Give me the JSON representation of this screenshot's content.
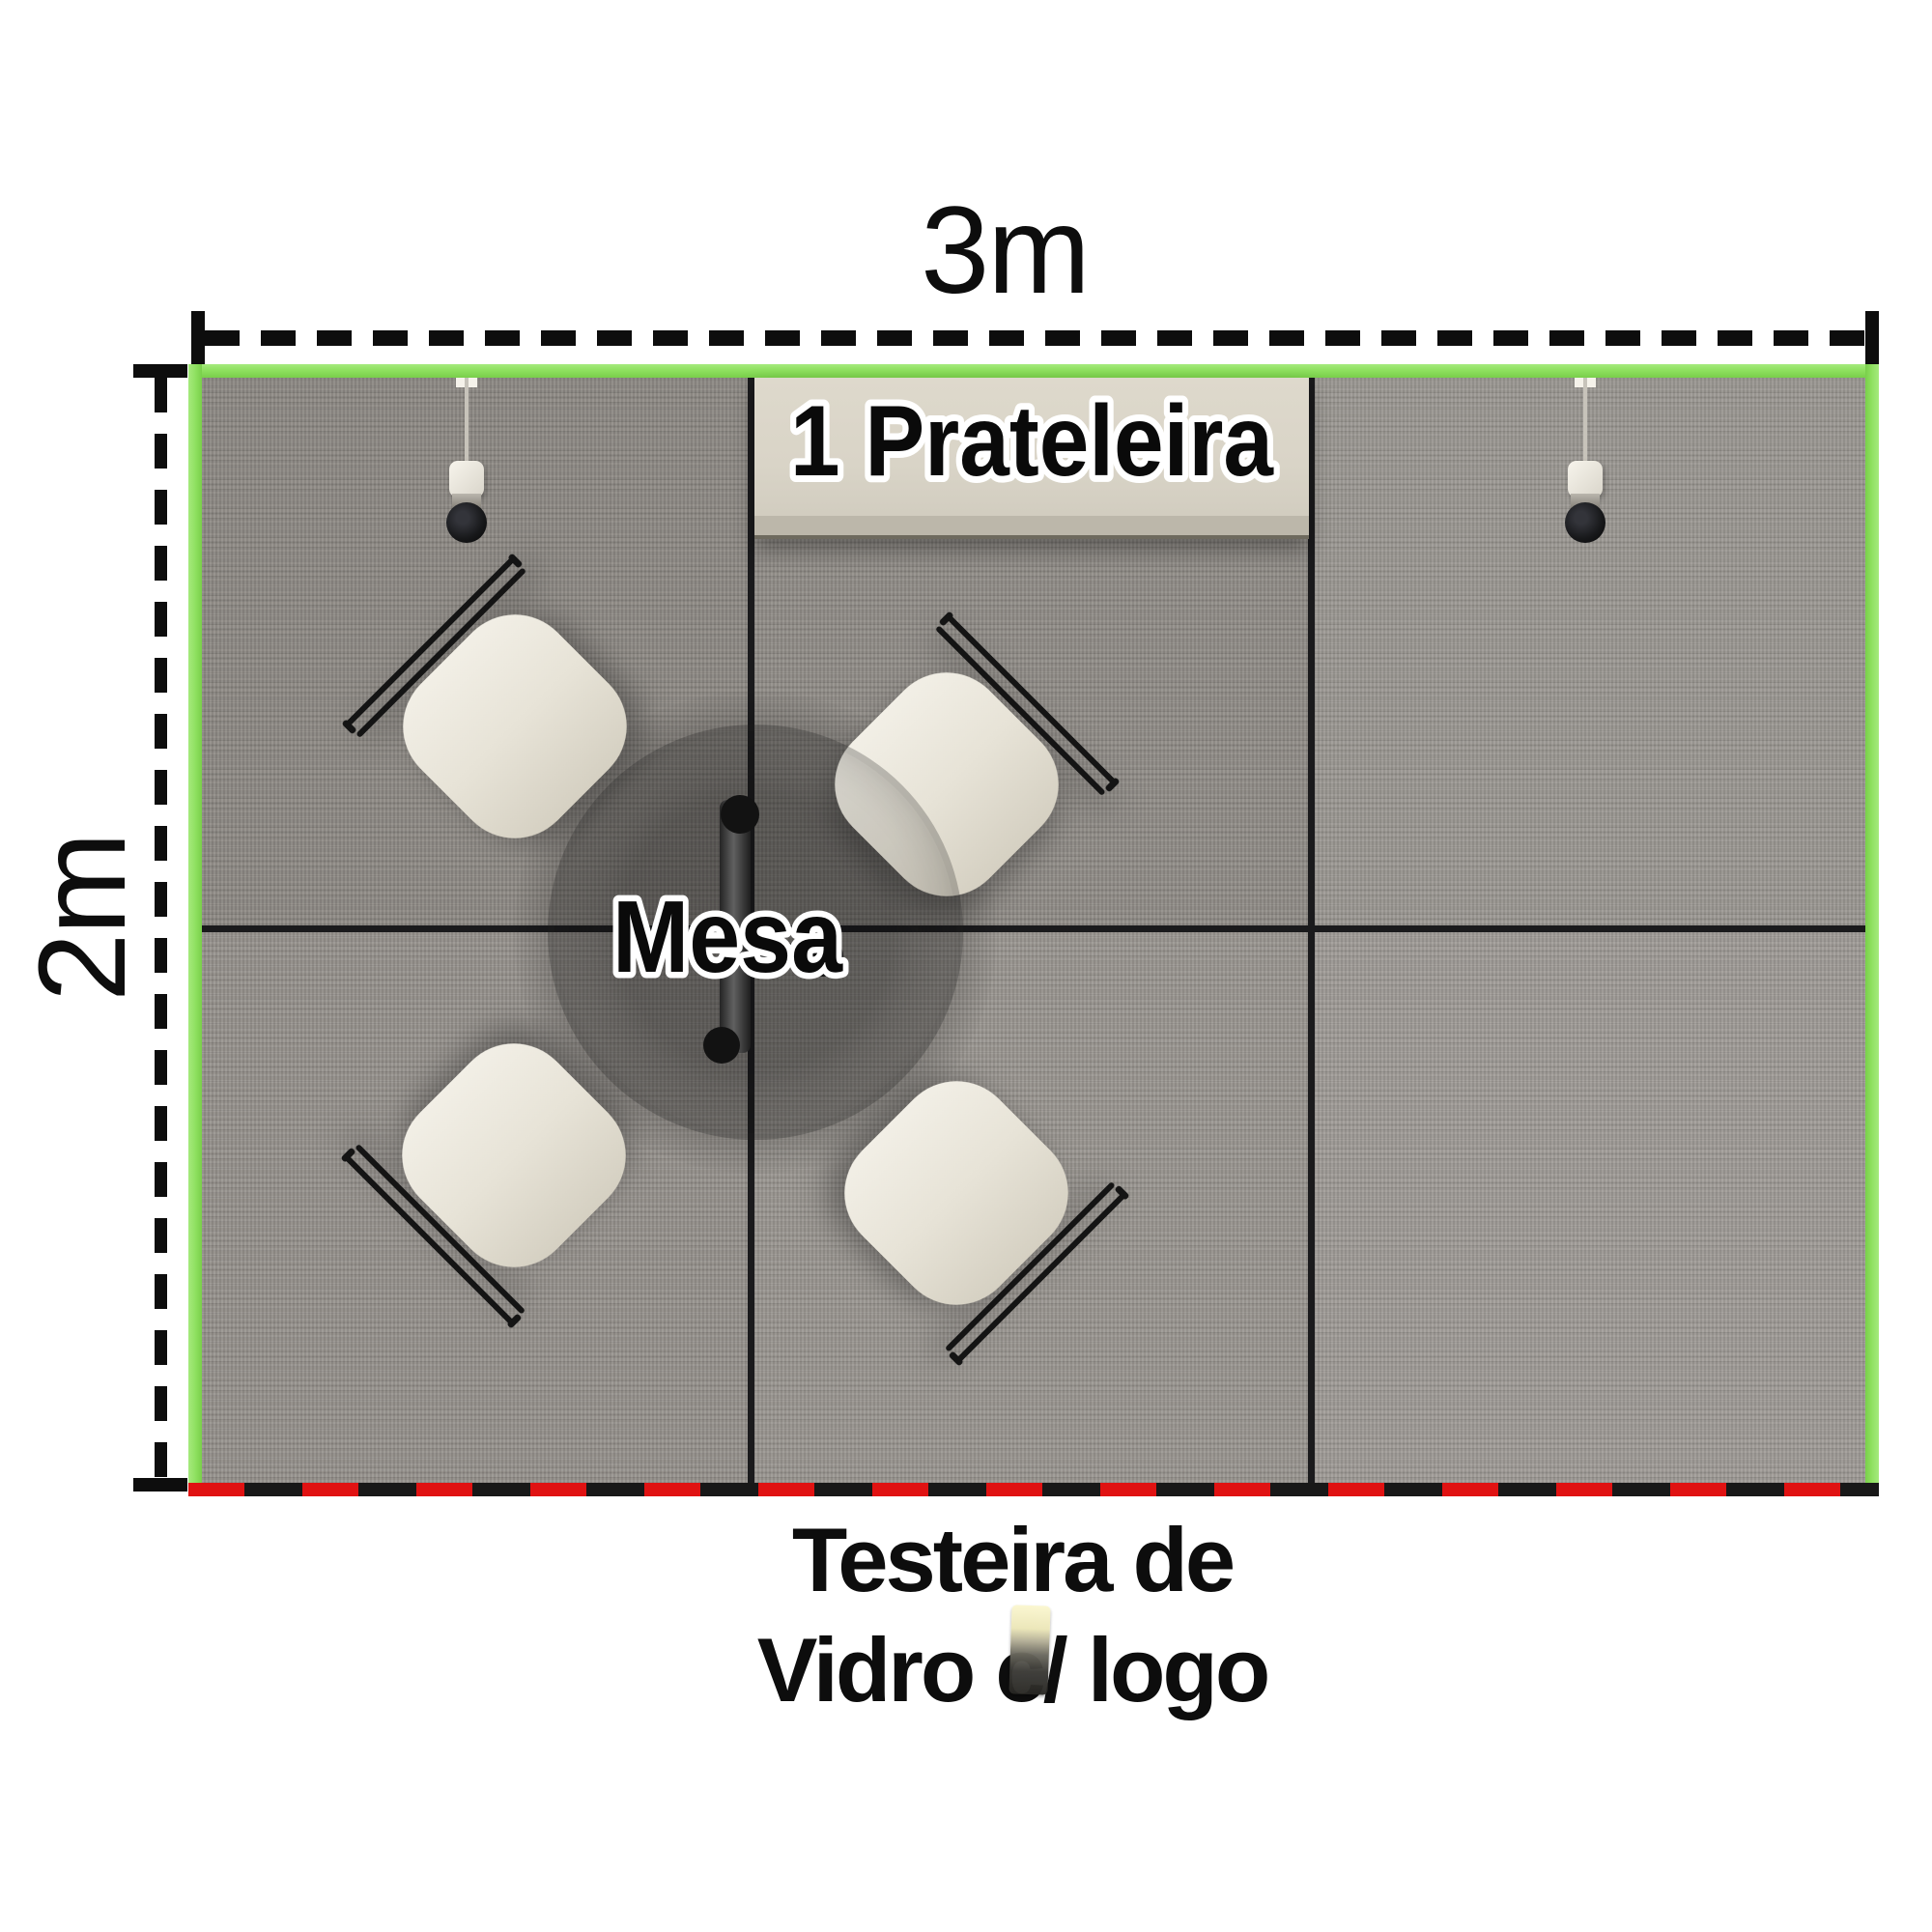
{
  "dimension_labels": {
    "width": "3m",
    "height": "2m"
  },
  "annotations": {
    "shelf_label": "1 Prateleira",
    "table_label": "Mesa",
    "front_banner_line1": "Testeira de",
    "front_banner_line2": "Vidro c/ logo"
  },
  "scene": {
    "chairs_visible": 4,
    "ceiling_spotlights_visible": 2,
    "icon_names": [
      "spotlight-icon",
      "lamp-icon"
    ]
  },
  "colors": {
    "wall_green": "#8ee05f",
    "front_red": "#e01212",
    "carpet_gray": "#9a9691",
    "shelf_beige": "#d9d4c7",
    "chair_cream": "#eae6db",
    "ink_black": "#0d0d0d"
  }
}
